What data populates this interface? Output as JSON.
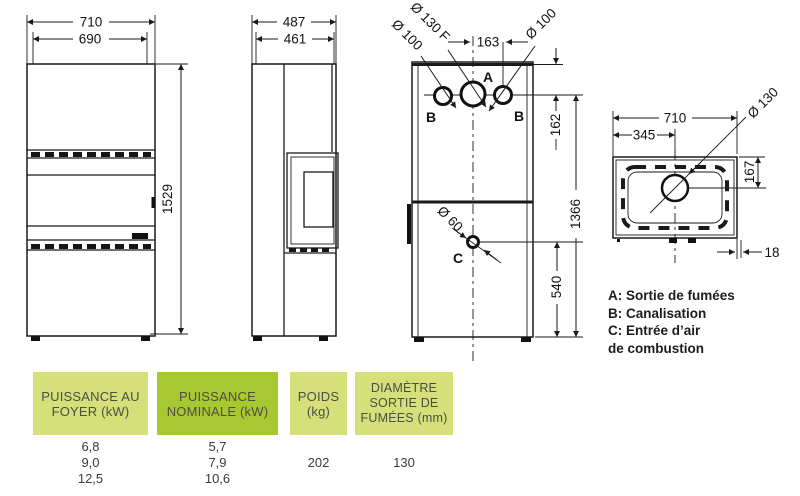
{
  "colors": {
    "line": "#1a1a1a",
    "table_light_green": "#d5e07a",
    "table_dark_green": "#a8c832",
    "table_header_text": "#4d4d42",
    "table_value_text": "#3a3a3a",
    "legend_text": "#1c1c1a"
  },
  "views": {
    "front": {
      "dim_width_outer": "710",
      "dim_width_inner": "690",
      "dim_height": "1529"
    },
    "side": {
      "dim_depth_outer": "487",
      "dim_depth_inner": "461"
    },
    "back": {
      "dim_flue_offset": "163",
      "label_flue": "Ø 130 F",
      "label_duct_left": "Ø 100",
      "label_duct_right": "Ø 100",
      "label_air_inlet": "Ø 60",
      "dim_top_to_flue_center": "162",
      "dim_flue_center_to_floor": "1366",
      "dim_air_center_to_floor": "540",
      "marker_a": "A",
      "marker_b_left": "B",
      "marker_b_right": "B",
      "marker_c": "C"
    },
    "top": {
      "dim_width": "710",
      "dim_flue_center_x": "345",
      "label_flue": "Ø 130",
      "dim_flue_center_y": "167",
      "dim_rear_gap": "18"
    }
  },
  "legend": {
    "line_a": "A: Sortie de fumées",
    "line_b": "B: Canalisation",
    "line_c": "C: Entrée d’air",
    "line_c2": "de combustion"
  },
  "table": {
    "columns": [
      {
        "header_lines": [
          "PUISSANCE AU",
          "FOYER (kW)"
        ],
        "values": [
          "6,8",
          "9,0",
          "12,5"
        ]
      },
      {
        "header_lines": [
          "PUISSANCE",
          "NOMINALE (kW)"
        ],
        "values": [
          "5,7",
          "7,9",
          "10,6"
        ]
      },
      {
        "header_lines": [
          "POIDS",
          "(kg)"
        ],
        "values": [
          "202"
        ]
      },
      {
        "header_lines": [
          "DIAMÈTRE",
          "SORTIE DE",
          "FUMÉES (mm)"
        ],
        "values": [
          "130"
        ]
      }
    ]
  }
}
